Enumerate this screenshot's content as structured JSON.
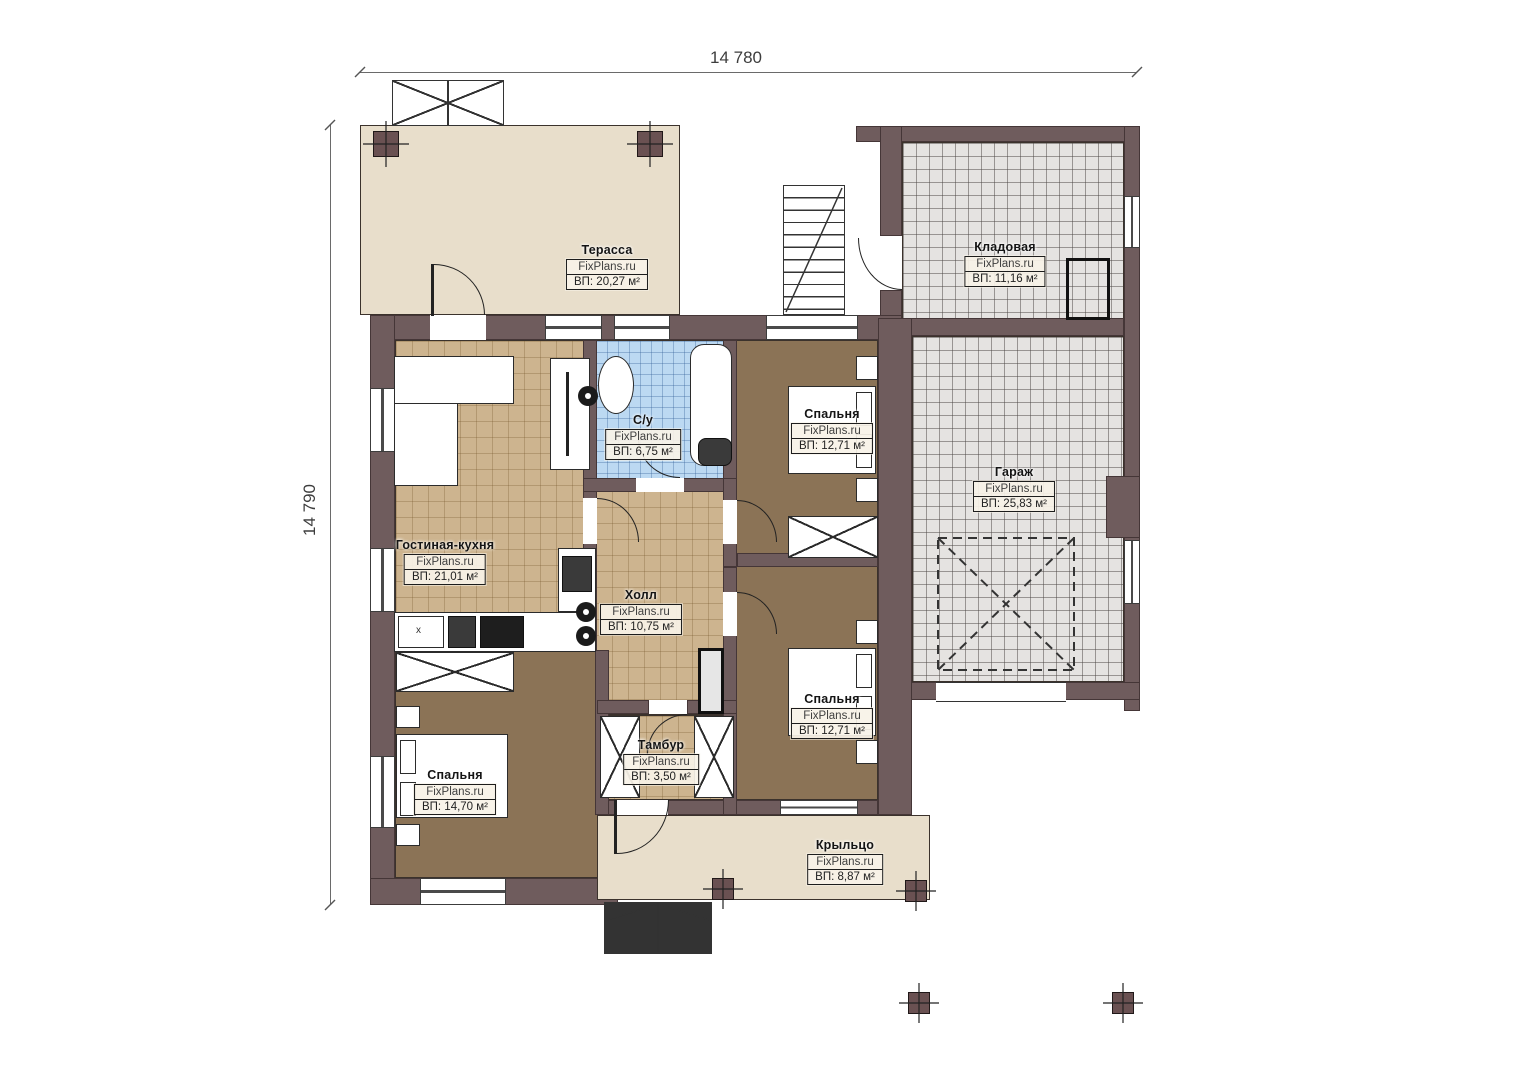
{
  "plan": {
    "brand": "FixPlans.ru",
    "dimensions": {
      "top": "14 780",
      "left": "14 790"
    },
    "rooms": [
      {
        "key": "terrace",
        "name": "Терасса",
        "area": "ВП: 20,27 м²"
      },
      {
        "key": "storage",
        "name": "Кладовая",
        "area": "ВП: 11,16 м²"
      },
      {
        "key": "garage",
        "name": "Гараж",
        "area": "ВП: 25,83 м²"
      },
      {
        "key": "bedroom-top",
        "name": "Спальня",
        "area": "ВП: 12,71 м²"
      },
      {
        "key": "bathroom",
        "name": "С/у",
        "area": "ВП: 6,75 м²"
      },
      {
        "key": "living-kitchen",
        "name": "Гостиная-кухня",
        "area": "ВП: 21,01 м²"
      },
      {
        "key": "hall",
        "name": "Холл",
        "area": "ВП: 10,75 м²"
      },
      {
        "key": "bedroom-right",
        "name": "Спальня",
        "area": "ВП: 12,71 м²"
      },
      {
        "key": "vestibule",
        "name": "Тамбур",
        "area": "ВП: 3,50 м²"
      },
      {
        "key": "bedroom-left",
        "name": "Спальня",
        "area": "ВП: 14,70 м²"
      },
      {
        "key": "porch",
        "name": "Крыльцо",
        "area": "ВП: 8,87 м²"
      }
    ],
    "kitchen_sink_mark": "х",
    "colors": {
      "wall": "#6f5c5d",
      "terrace_floor": "#e8decb",
      "wood_floor": "#cdb48f",
      "bedroom_floor": "#8b7356",
      "bathroom_floor": "#bcd9f2",
      "garage_floor": "#e5e3e1"
    }
  }
}
